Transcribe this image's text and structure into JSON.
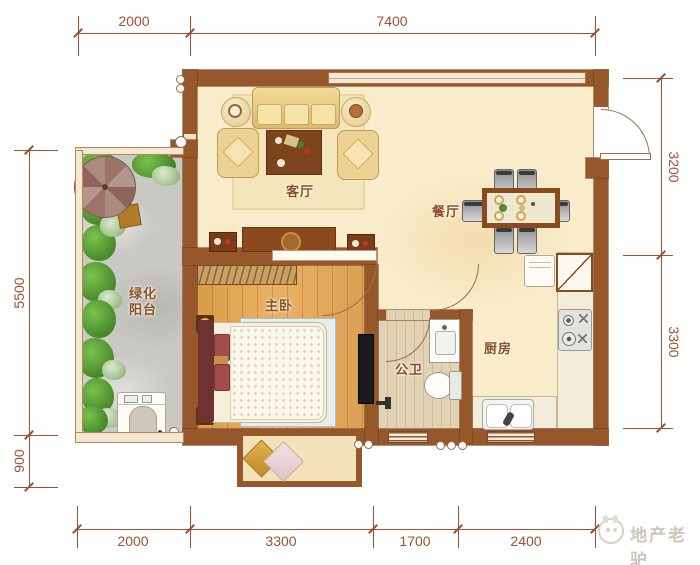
{
  "plan": {
    "rooms": {
      "living": {
        "name": "客厅"
      },
      "dining": {
        "name": "餐厅"
      },
      "bedroom": {
        "name": "主卧"
      },
      "bathroom": {
        "name": "公卫"
      },
      "kitchen": {
        "name": "厨房"
      },
      "balcony": {
        "name_line1": "绿化",
        "name_line2": "阳台"
      }
    },
    "dimensions": {
      "top": {
        "d1": "2000",
        "d2": "7400"
      },
      "bottom": {
        "d1": "2000",
        "d2": "3300",
        "d3": "1700",
        "d4": "2400"
      },
      "left": {
        "d1": "5500",
        "d2": "900"
      },
      "right": {
        "d1": "3200",
        "d2": "3300"
      }
    },
    "watermark": {
      "text": "地产老驴"
    },
    "colors": {
      "wall": "#96572b",
      "dimension": "#9d5130",
      "label": "#8a5024"
    }
  }
}
